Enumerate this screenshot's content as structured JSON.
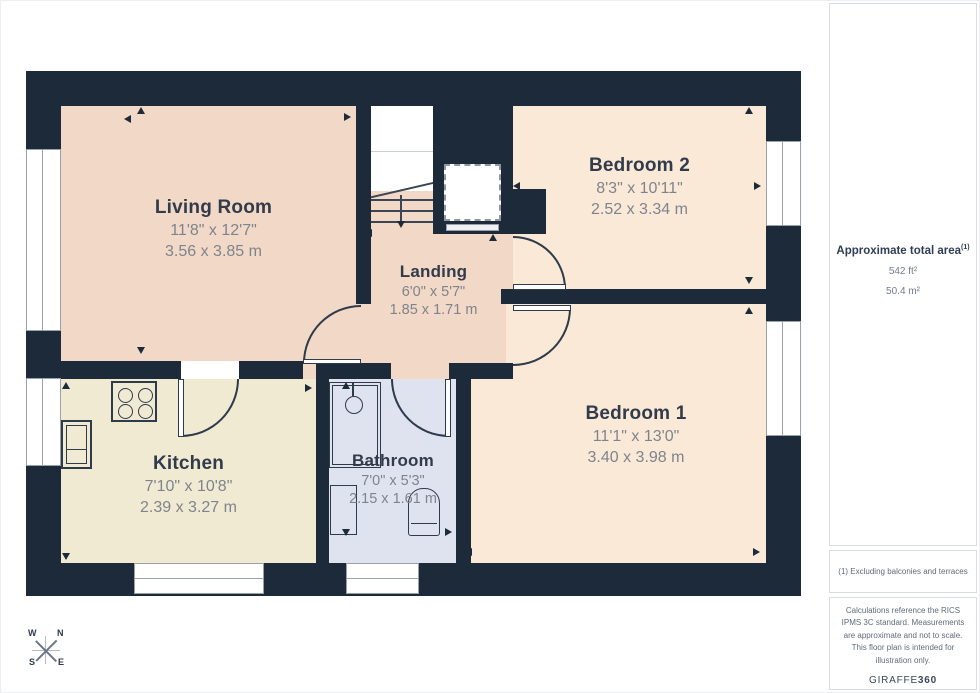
{
  "rooms": [
    {
      "name": "Living Room",
      "imperial": "11'8\" x 12'7\"",
      "metric": "3.56 x 3.85 m"
    },
    {
      "name": "Bedroom 2",
      "imperial": "8'3\" x 10'11\"",
      "metric": "2.52 x 3.34 m"
    },
    {
      "name": "Landing",
      "imperial": "6'0\" x 5'7\"",
      "metric": "1.85 x 1.71 m"
    },
    {
      "name": "Bedroom 1",
      "imperial": "11'1\" x 13'0\"",
      "metric": "3.40 x 3.98 m"
    },
    {
      "name": "Kitchen",
      "imperial": "7'10\" x 10'8\"",
      "metric": "2.39 x 3.27 m"
    },
    {
      "name": "Bathroom",
      "imperial": "7'0\" x 5'3\"",
      "metric": "2.15 x 1.61 m"
    }
  ],
  "sidebar": {
    "total_area_label": "Approximate total area",
    "total_area_footnote_ref": "(1)",
    "area_ft": "542 ft²",
    "area_m": "50.4 m²",
    "footnote": "(1) Excluding balconies and terraces",
    "disclaimer": "Calculations reference the RICS IPMS 3C standard. Measurements are approximate and not to scale. This floor plan is intended for illustration only.",
    "brand_name": "GIRAFFE",
    "brand_suffix": "360"
  },
  "compass": {
    "n": "N",
    "e": "E",
    "s": "S",
    "w": "W"
  },
  "colors": {
    "wall": "#1d2a39",
    "living_room_landing": "#f2d8c6",
    "bedrooms": "#fbe9d7",
    "kitchen": "#f1ead3",
    "bathroom": "#dfe3ef",
    "sidebar_border": "#d9dce1"
  }
}
